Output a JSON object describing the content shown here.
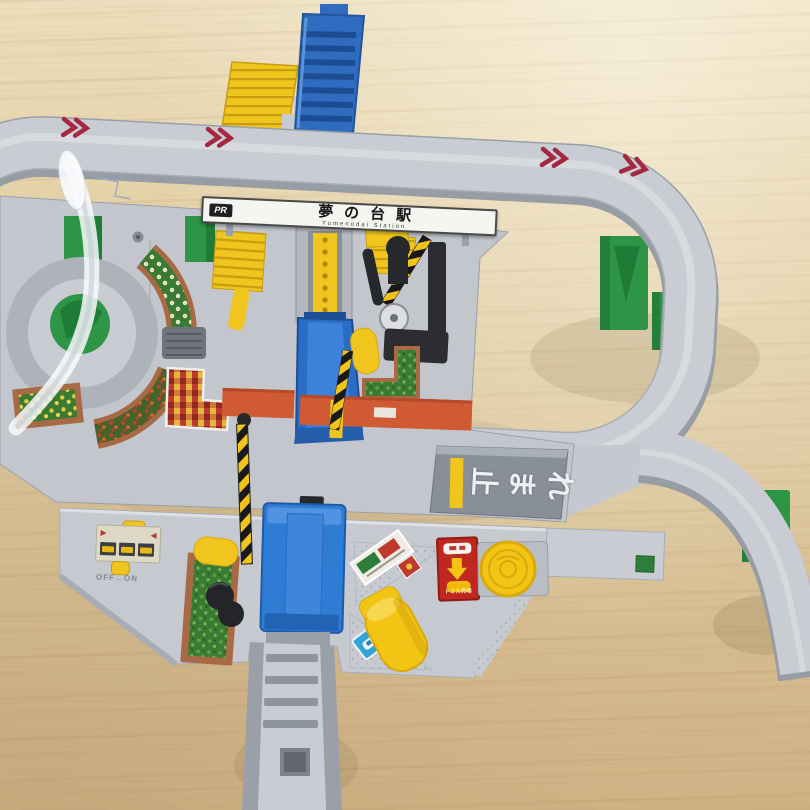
{
  "station_sign": {
    "logo": "PR",
    "name": "夢の台駅",
    "romaji": "Yumenodai Station"
  },
  "stop_ramp": {
    "text": "止まれ",
    "chars": [
      "止",
      "ま",
      "れ"
    ]
  },
  "control_panel": {
    "switch_label": "OFF←ON"
  },
  "tomica_corner": {
    "caption": "トミカ売場"
  },
  "colors": {
    "wood": "#dcc69c",
    "track_gray": "#c9cdd3",
    "pier_green": "#2e9446",
    "plarail_blue": "#2f6cc0",
    "accent_yellow": "#efc51e",
    "chevron_red": "#a32840",
    "road_orange": "#cf5a33",
    "lift_blue": "#2e7cd4",
    "sticker_red": "#c0271f",
    "hedge_green": "#3b7a32",
    "brick_border": "#a86a45",
    "stop_ramp_gray": "#898f98"
  },
  "icons": {
    "direction_chevrons": "»»",
    "bus_icons": "🚌🚌🚌",
    "down_arrow_icon": "▼",
    "car_icon": "🚗",
    "coin_button_icon": "●",
    "flower_stickers": "✿"
  }
}
